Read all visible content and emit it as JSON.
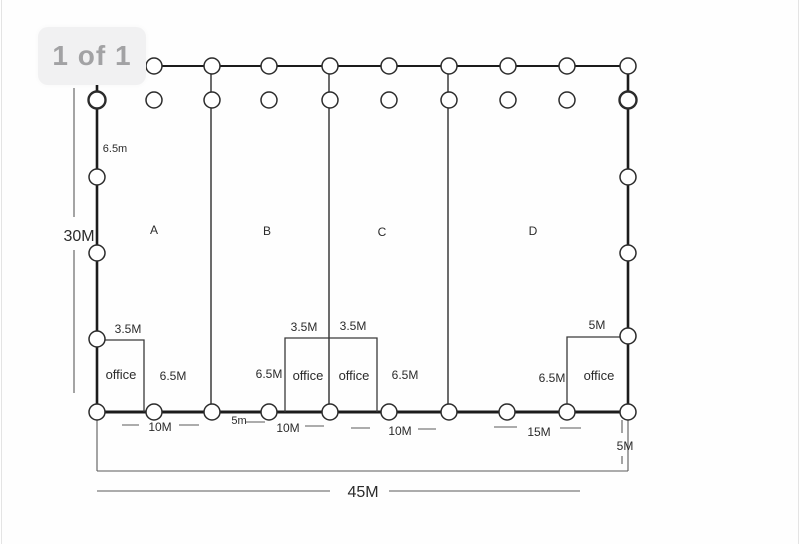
{
  "badge": {
    "label": "1 of 1"
  },
  "plan": {
    "sections": [
      "A",
      "B",
      "C",
      "D"
    ],
    "overall": {
      "width": "45M",
      "height": "30M",
      "bay_height": "6.5m",
      "corner_offset": "5M"
    },
    "offices": [
      {
        "name": "office",
        "width": "3.5M",
        "depth": "6.5M"
      },
      {
        "name": "office",
        "width": "3.5M",
        "depth": "6.5M"
      },
      {
        "name": "office",
        "width": "3.5M",
        "depth": "6.5M"
      },
      {
        "name": "office",
        "width": "5M",
        "depth": "6.5M"
      }
    ],
    "bottom_dims": [
      "10M",
      "5m",
      "10M",
      "10M",
      "15M"
    ]
  }
}
